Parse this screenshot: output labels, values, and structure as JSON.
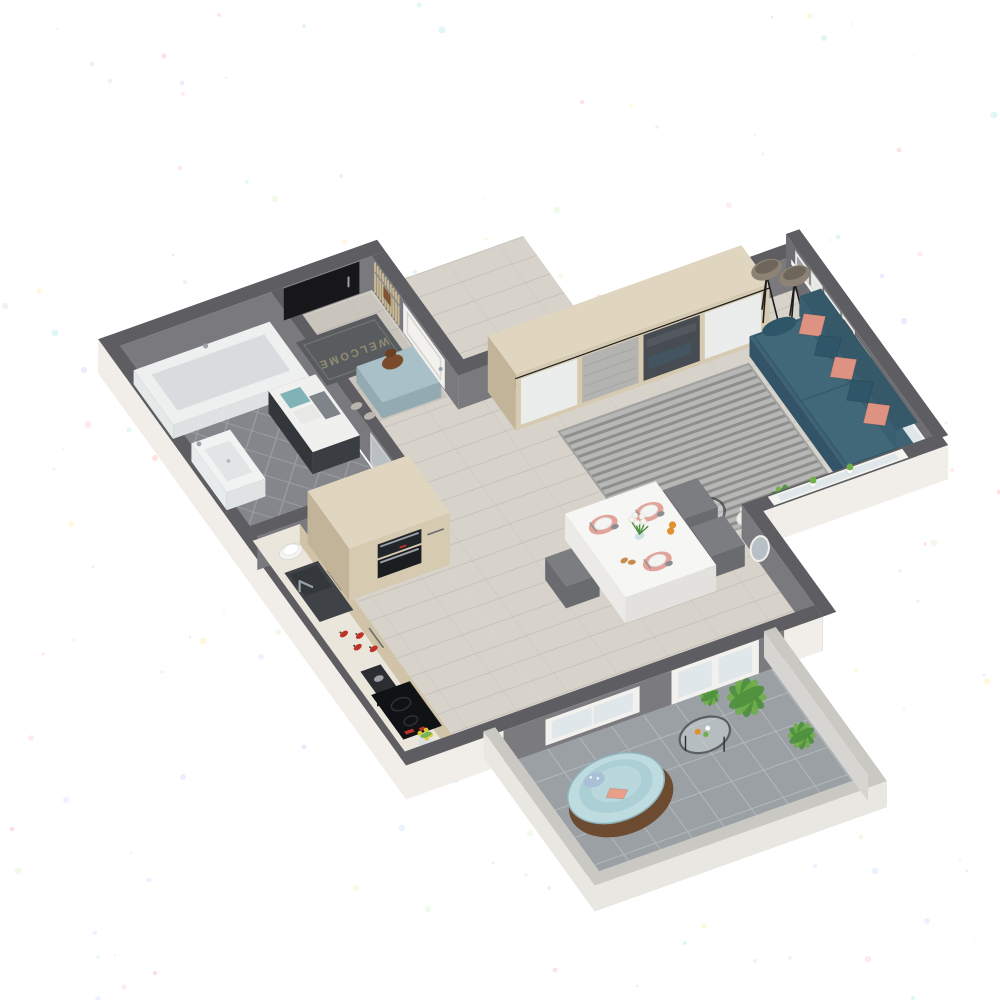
{
  "scene": {
    "type": "isometric-floorplan-render",
    "description": "3D cutaway floor plan render of a one-room apartment with balcony, on white speckled paper background",
    "rooms": [
      "Bathroom",
      "Entry hall",
      "Kitchen",
      "Dining area",
      "Living room",
      "Balcony"
    ]
  },
  "entry": {
    "name": "Entry hall",
    "doormat_text": "WELCOME",
    "items": [
      "front-door",
      "doormat",
      "ottoman",
      "handbag",
      "slippers",
      "coat-rack-slats",
      "interior-door"
    ]
  },
  "bathroom": {
    "name": "Bathroom",
    "items": [
      "bathtub",
      "washbasin",
      "vanity-cabinet",
      "towels",
      "glass-door",
      "diamond-tile-floor"
    ]
  },
  "kitchen": {
    "name": "Kitchen",
    "items": [
      "counter",
      "sink",
      "faucet",
      "plate-stack",
      "red-peppers",
      "coffee-grinder",
      "induction-cooktop",
      "tall-cabinet",
      "built-in-oven",
      "microwave",
      "flower-pot"
    ],
    "pepper_count": 4
  },
  "dining": {
    "name": "Dining area",
    "items": [
      "dining-table",
      "chairs",
      "placemats",
      "plates",
      "napkins",
      "flower-vase",
      "oranges",
      "croissants",
      "wall-mirror",
      "radiator",
      "balcony-door",
      "balcony-window"
    ],
    "place_settings": 3,
    "chair_count": 3
  },
  "living": {
    "name": "Living room",
    "items": [
      "wardrobe",
      "sliding-doors",
      "floor-lamps",
      "sofa",
      "cushions",
      "striped-rug",
      "picture-ledge",
      "picture-frames",
      "coffee-table",
      "teal-bowl",
      "candles",
      "potted-plant",
      "windows",
      "sill-plants"
    ],
    "wardrobe_panels": 4,
    "lamp_count": 2,
    "frame_count": 5,
    "cushions": {
      "salmon": 3,
      "teal": 2,
      "bolster": 1
    }
  },
  "balcony": {
    "name": "Balcony",
    "items": [
      "papasan-chair",
      "peach-pillow",
      "pattern-pillow",
      "round-glass-table",
      "potted-plants",
      "tile-floor",
      "parapet"
    ],
    "plant_count": 3
  },
  "colors": {
    "paper": "#ffffff",
    "wallTop": "#5e5e62",
    "wallInner": "#7a7a7e",
    "wallOuter": "#f1eee9",
    "floorWood": "#d7d2ca",
    "floorWoodLine": "#c5bfb6",
    "bathTile": "#84868b",
    "bathTileLine": "#9a9da2",
    "balconyTile": "#9aa0a4",
    "balconyGrout": "#b7bcbf",
    "rug": "#b7b7b5",
    "rugStripe": "#8e8e8c",
    "wood": "#d6cab0",
    "woodSide": "#c2b499",
    "woodTop": "#e0d6bf",
    "black": "#17171a",
    "steel": "#9aa2a8",
    "panelWhite": "#ebedec",
    "panelKnit": "#b3b3b1",
    "panelMirror": "#474c52",
    "sofa": "#3d6273",
    "sofaDark": "#335468",
    "seat": "#416879",
    "pillowSalmon": "#dd9282",
    "pillowTeal": "#2f5668",
    "lampShade": "#8d8375",
    "lampInner": "#6e665b",
    "counter": "#eae6dc",
    "cabinetFront": "#d0c3a8",
    "sink": "#3f4347",
    "cooktop": "#101215",
    "ovenBlack": "#1b1d20",
    "red": "#c03227",
    "tableWhite": "#f6f6f4",
    "tableSide": "#e3e1dd",
    "chair": "#7c7d81",
    "chairSide": "#6a6b6f",
    "placemat": "#e2a49a",
    "plateWhite": "#f4f4f2",
    "napkin": "#8b8d92",
    "orange": "#e2902f",
    "croissant": "#c98a4b",
    "leafDark": "#4e8f3e",
    "leafLight": "#6fae4a",
    "potWhite": "#e9e7e3",
    "glass": "#ccd6d8",
    "rim": "#2b2b2d",
    "bowlTeal": "#1f9aa0",
    "mat": "#595c5f",
    "matText": "#938c72",
    "ottoman": "#a9c0c8",
    "ottomanSide": "#93aab2",
    "bag": "#7a4a2b",
    "mirrorGlass": "#b7c0c4",
    "ledge": "#f3f3f1",
    "frame": "#e8e8e6",
    "frameArt": "#9aa2a6",
    "artDark": "#4d3f2c",
    "windowGlass": "#dfe7ea",
    "doorWhite": "#f2f1ee",
    "radiator": "#eceae6",
    "papasan": "#bedbe0",
    "papasanInner": "#a9cdd4",
    "papasanFrame": "#6d4b31",
    "peach": "#ea9f88",
    "patternPillow": "#a9c0d6",
    "parapetTop": "#c9c8c2",
    "parapetFace": "#e9e7e2",
    "parapetInner": "#d6d5d1",
    "towelTeal": "#7fb3b8",
    "vanityDark": "#3a3d42",
    "tub": "#eef0f0",
    "tubInner": "#d9dcde",
    "basin": "#f1f2f2"
  }
}
